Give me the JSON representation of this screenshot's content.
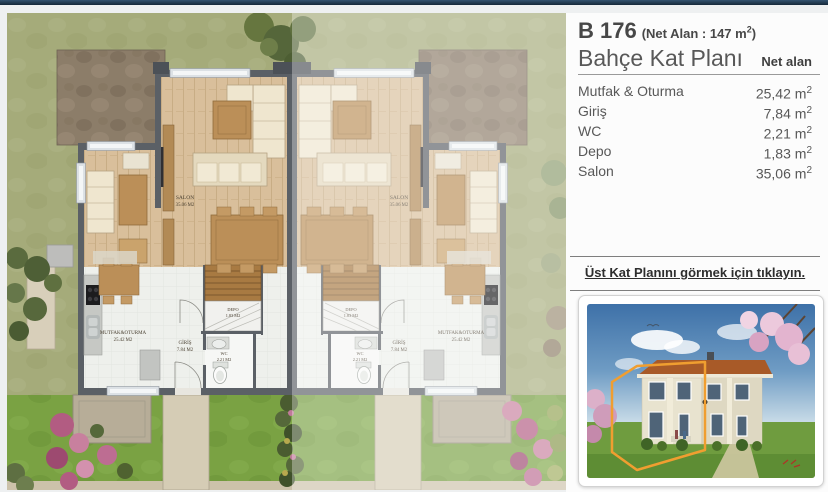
{
  "colors": {
    "top_bar": "#1d3148",
    "page_background": "#eef0f1",
    "panel_background": "#fcfcfc",
    "heading_text": "#474747",
    "body_text": "#585858",
    "link_text": "#2e2e2e",
    "divider": "#8f8f8f",
    "plan_grass": "#a5ab7a",
    "plan_garden": "#7aa243",
    "plan_walls": "#5b6066",
    "plan_wood_floor": "#d9bf9b",
    "highlight_orange": "#f09e30"
  },
  "header": {
    "unit_code": "B 176",
    "net_area_prefix": "(Net Alan : 147 m",
    "net_area_sup": "2",
    "net_area_suffix": ")",
    "plan_title": "Bahçe Kat Planı",
    "area_column_label": "Net alan"
  },
  "rooms": [
    {
      "label": "Mutfak & Oturma",
      "area": "25,42",
      "unit": " m",
      "sup": "2"
    },
    {
      "label": "Giriş",
      "area": "7,84",
      "unit": " m",
      "sup": "2"
    },
    {
      "label": "WC",
      "area": "2,21",
      "unit": " m",
      "sup": "2"
    },
    {
      "label": "Depo",
      "area": "1,83",
      "unit": " m",
      "sup": "2"
    },
    {
      "label": "Salon",
      "area": "35,06",
      "unit": " m",
      "sup": "2"
    }
  ],
  "upper_floor_link": {
    "label": "Üst Kat Planını görmek için tıklayın."
  },
  "floor_plan": {
    "labels": {
      "salon": "SALON",
      "salon_area": "35.06 M2",
      "mutfak": "MUTFAK&OTURMA",
      "mutfak_area": "25.42 M2",
      "giris": "GİRİŞ",
      "giris_area": "7.84 M2",
      "depo": "DEPO",
      "depo_area": "1.83 M2",
      "wc": "WC",
      "wc_area": "2.21 M2"
    }
  }
}
